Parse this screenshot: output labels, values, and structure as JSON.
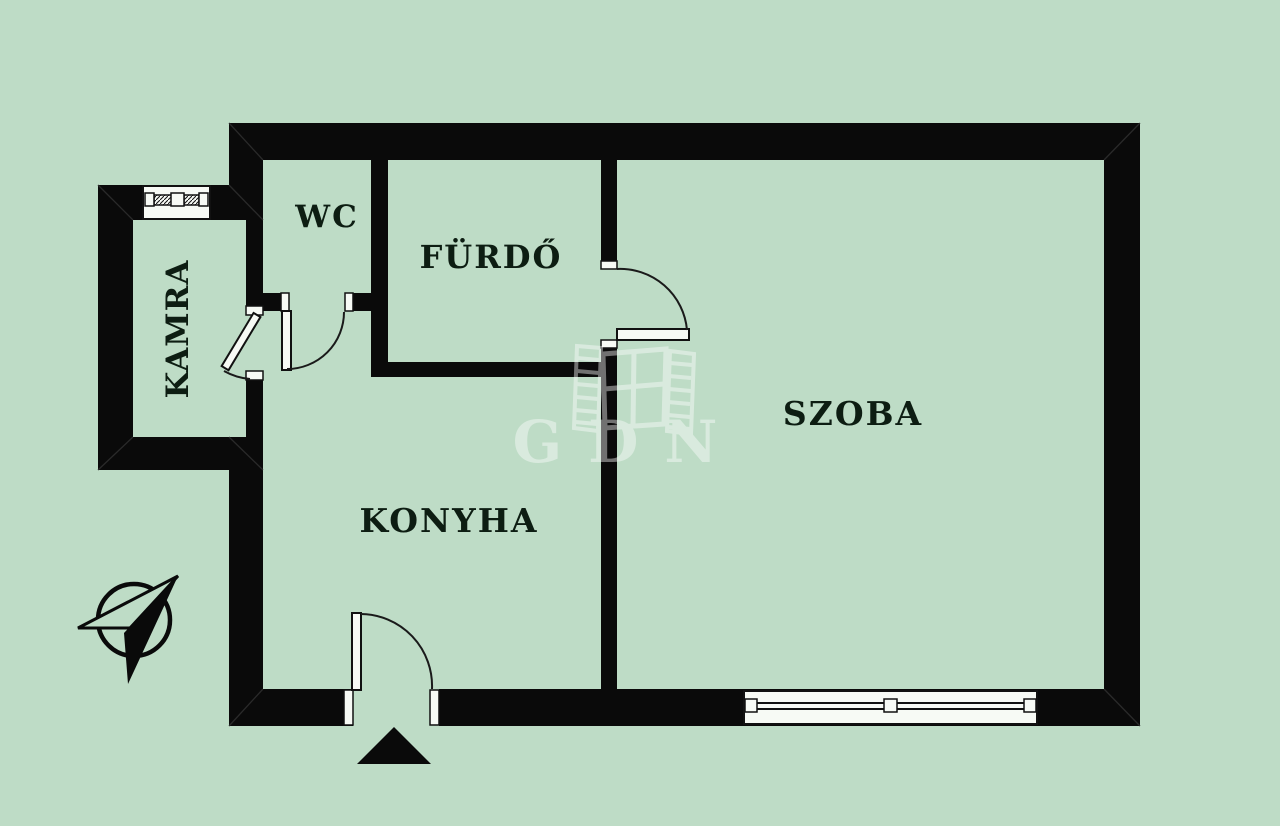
{
  "page": {
    "type": "apartment-floor-plan",
    "background_color": "#bedcc6"
  },
  "colors": {
    "wall": "#0a0a0a",
    "label_text": "#0d1d12",
    "fixture_fill": "#f7faf5",
    "watermark": "#ffffff"
  },
  "rooms": [
    {
      "id": "wc",
      "label": "WC"
    },
    {
      "id": "furdo",
      "label": "FÜRDŐ"
    },
    {
      "id": "kamra",
      "label": "KAMRA",
      "orientation": "vertical"
    },
    {
      "id": "konyha",
      "label": "KONYHA"
    },
    {
      "id": "szoba",
      "label": "SZOBA"
    }
  ],
  "watermark": {
    "text": "GDN",
    "logo": "gdn-window-logo"
  },
  "symbols": {
    "north_arrow": "north-arrow-compass",
    "entrance_marker": "entrance-triangle",
    "doors": [
      "kamra-door",
      "wc-door",
      "furdo-szoba-door",
      "entrance-door"
    ],
    "windows": [
      "kamra-window",
      "szoba-window"
    ]
  }
}
